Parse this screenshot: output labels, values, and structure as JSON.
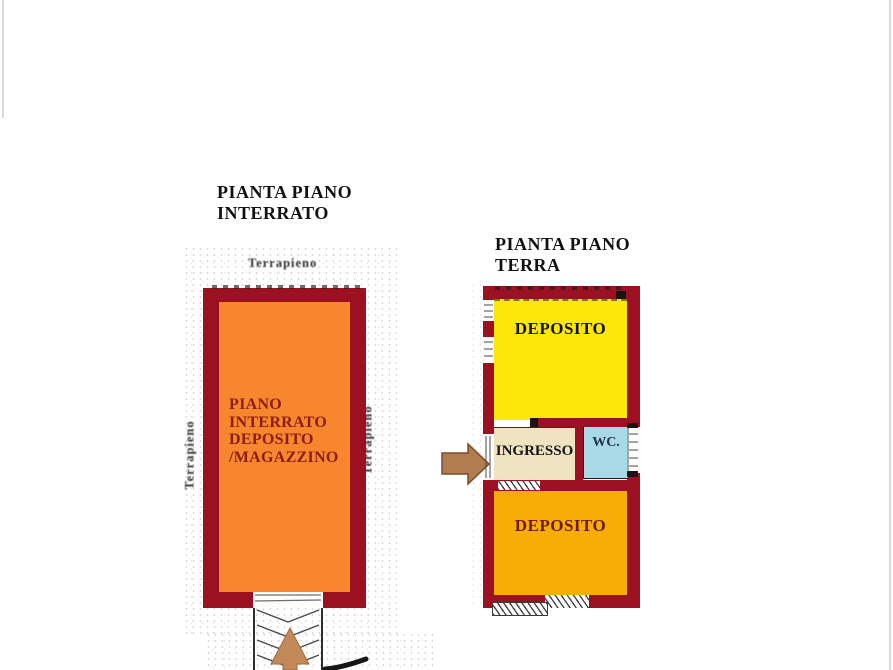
{
  "basement": {
    "title": [
      "PIANTA PIANO",
      "INTERRATO"
    ],
    "room_label": [
      "PIANO",
      "INTERRATO",
      "DEPOSITO",
      "/MAGAZZINO"
    ],
    "terrain_label_top": "Terrapieno",
    "terrain_label_left": "Terrapieno",
    "terrain_label_right": "Terrapieno"
  },
  "ground": {
    "title": [
      "PIANTA PIANO",
      "TERRA"
    ],
    "rooms": {
      "deposito_top": "DEPOSITO",
      "ingresso": "INGRESSO",
      "wc": "WC.",
      "deposito_bottom": "DEPOSITO"
    }
  },
  "colors": {
    "wall": "#9c1122",
    "basement_room": "#f7862e",
    "basement_label": "#8c1d12",
    "deposito_top": "#fbe70a",
    "ingresso": "#efe3c2",
    "wc": "#a9d8e7",
    "deposito_bottom": "#f7ad05",
    "entrance_arrow": "#b17c50",
    "ramp_arrow": "#c18a58"
  }
}
